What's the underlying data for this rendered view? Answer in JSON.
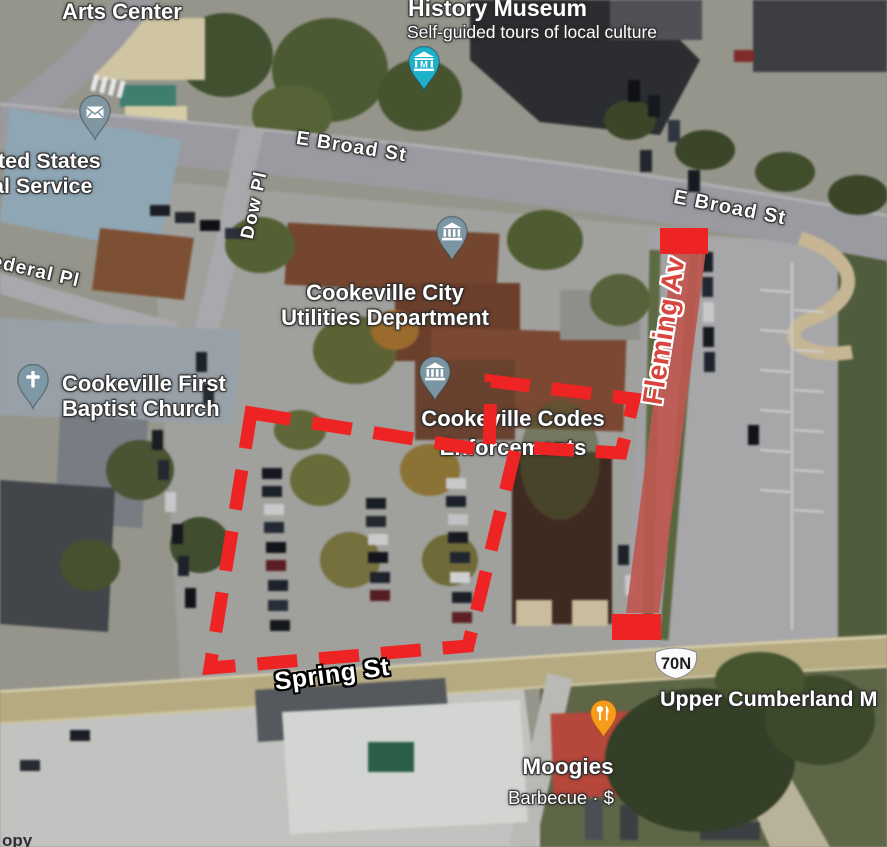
{
  "map": {
    "attribution_fragment": "opy",
    "poi": {
      "arts_center": "Arts Center",
      "history_museum_title": "History Museum",
      "history_museum_subtitle": "Self-guided tours of local culture",
      "postal_line1": "ted States",
      "postal_line2": "al Service",
      "utilities_line1": "Cookeville City",
      "utilities_line2": "Utilities Department",
      "church_line1": "Cookeville First",
      "church_line2": "Baptist Church",
      "codes_line1": "Cookeville Codes",
      "codes_line2": "Enforcements",
      "moogies_title": "Moogies",
      "moogies_subtitle": "Barbecue · $",
      "upper_cumberland": "Upper Cumberland M"
    },
    "streets": {
      "e_broad_west": "E Broad St",
      "e_broad_east": "E Broad St",
      "dow_pl": "Dow Pl",
      "federal_pl": "ederal Pl",
      "spring_st": "Spring St",
      "route_shield": "70N"
    },
    "pins": {
      "history_museum": {
        "icon": "museum-m-icon",
        "color": "#1fb1c9"
      },
      "post_office": {
        "icon": "envelope-icon",
        "color": "#8096a1"
      },
      "utilities": {
        "icon": "government-building-icon",
        "color": "#7b95a2"
      },
      "codes": {
        "icon": "government-building-icon",
        "color": "#7b95a2"
      },
      "church": {
        "icon": "cross-icon",
        "color": "#7e99a5"
      },
      "moogies": {
        "icon": "restaurant-icon",
        "color": "#f89b1b"
      }
    }
  },
  "annotations": {
    "color": "#ee2424",
    "strip_color": "#bf564f",
    "strip_opacity": "0.9",
    "fleming_label": "Fleming Av",
    "fleming_text_style": "color:#d8453f",
    "polygon_points": "251,413 489,451 491,381 634,399 621,453 516,447 468,646 210,668",
    "strip_points": "673,251 706,251 659,613 626,613",
    "top_block_points": "660,228 708,228 708,254 660,254",
    "bottom_block_points": "612,614 661,614 661,640 612,640"
  }
}
